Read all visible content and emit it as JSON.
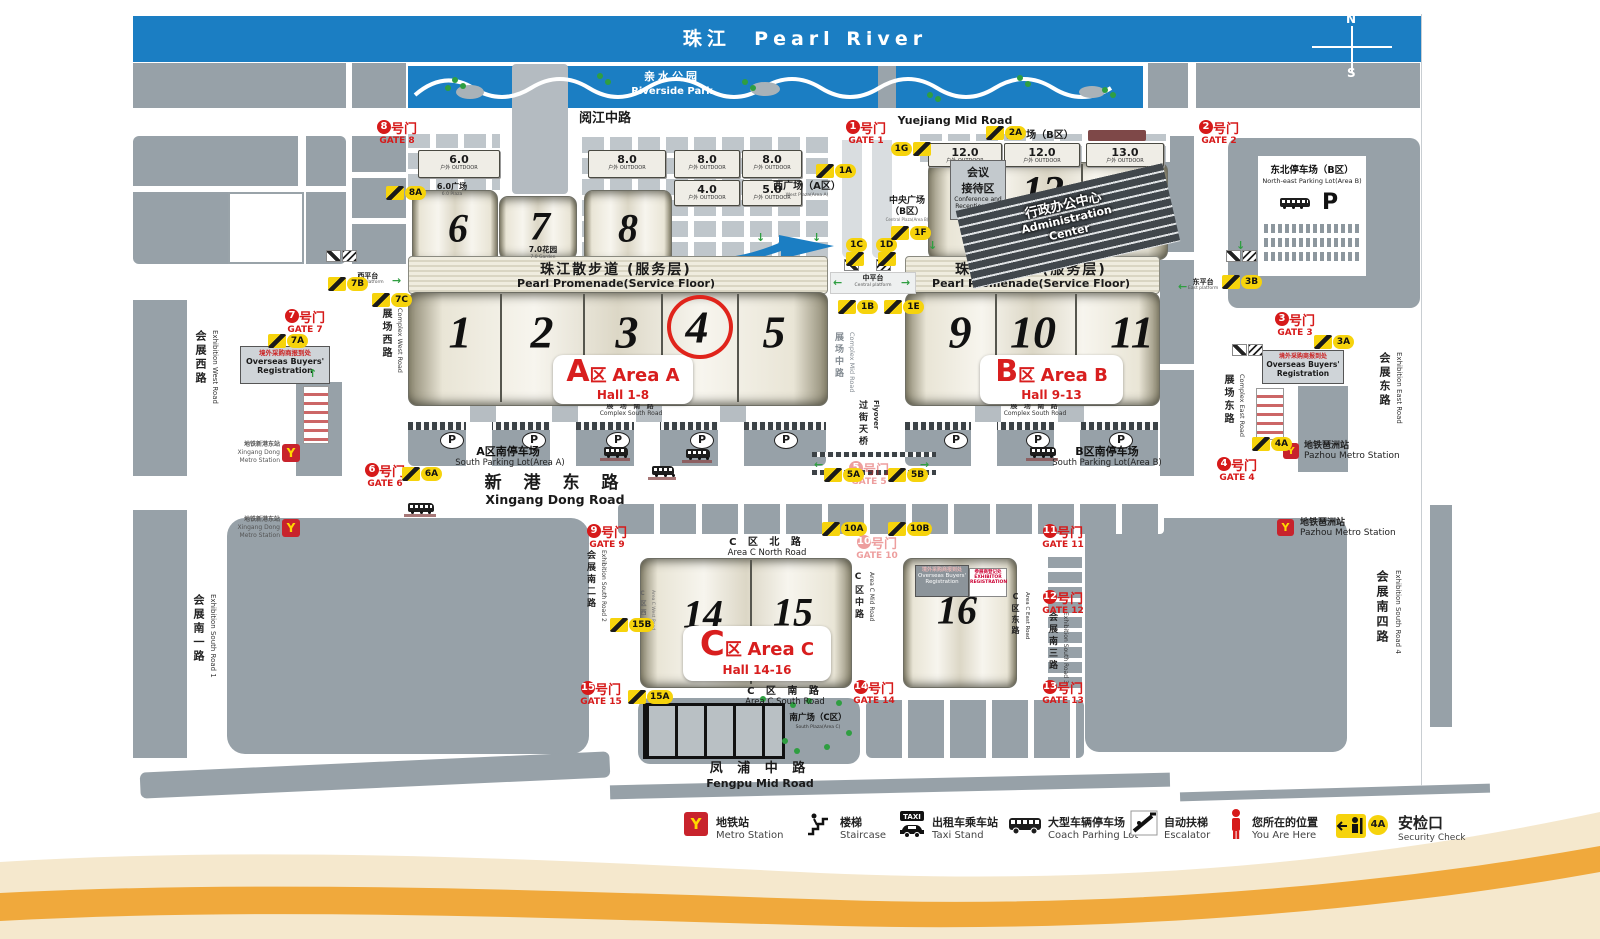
{
  "river": {
    "cn": "珠江",
    "en": "Pearl River"
  },
  "compass": {
    "n": "N",
    "s": "S"
  },
  "park": {
    "cn": "亲水公园",
    "en": "Riverside Park"
  },
  "promenade": {
    "cn": "珠江散步道 (服务层)",
    "en": "Pearl Promenade(Service Floor)"
  },
  "roads": {
    "yuejiang": {
      "cn": "阅江中路",
      "en": "Yuejiang  Mid Road"
    },
    "xingang": {
      "cn": "新 港 东 路",
      "en": "Xingang Dong Road"
    },
    "fengpu": {
      "cn": "凤 浦 中 路",
      "en": "Fengpu Mid Road"
    },
    "area_c_north": {
      "cn": "C 区 北 路",
      "en": "Area C  North  Road"
    },
    "area_c_south": {
      "cn": "C 区 南 路",
      "en": "Area C South  Road"
    },
    "area_c_mid": {
      "cn": "C区中路",
      "en": "Area C Mid Road"
    },
    "area_c_east": {
      "cn": "C区东路",
      "en": "Area C East Road"
    },
    "area_c_west": {
      "cn": "C区西路",
      "en": "Area C West Road"
    },
    "complex_west": {
      "cn": "展场西路",
      "en": "Complex West Road"
    },
    "complex_mid": {
      "cn": "展场中路",
      "en": "Complex Mid Road"
    },
    "complex_east": {
      "cn": "展场东路",
      "en": "Complex East Road"
    },
    "complex_south": {
      "cn": "展 场 南 路",
      "en": "Complex South Road"
    },
    "exhibition_west": {
      "cn": "会展西路",
      "en": "Exhibition West Road"
    },
    "exhibition_east": {
      "cn": "会展东路",
      "en": "Exhibition East Road"
    },
    "exh_south_1": {
      "cn": "会展南一路",
      "en": "Exhibition South Road 1"
    },
    "exh_south_2": {
      "cn": "会展南二路",
      "en": "Exhibition South Road 2"
    },
    "exh_south_3": {
      "cn": "会展南三路",
      "en": "Exhibition South Road 3"
    },
    "exh_south_4": {
      "cn": "会展南四路",
      "en": "Exhibition South Road 4"
    },
    "flyover": {
      "cn": "过街天桥",
      "en": "Flyover"
    }
  },
  "platforms": {
    "west": {
      "cn": "西平台",
      "en": "West platform"
    },
    "central": {
      "cn": "中平台",
      "en": "Central platform"
    },
    "east": {
      "cn": "东平台",
      "en": "East platform"
    }
  },
  "areas": {
    "a": {
      "letter": "A",
      "qu": "区",
      "en": "Area A",
      "halls": "Hall 1-8"
    },
    "b": {
      "letter": "B",
      "qu": "区",
      "en": "Area B",
      "halls": "Hall 9-13"
    },
    "c": {
      "letter": "C",
      "qu": "区",
      "en": "Area C",
      "halls": "Hall 14-16"
    }
  },
  "halls": [
    "1",
    "2",
    "3",
    "4",
    "5",
    "6",
    "7",
    "8",
    "9",
    "10",
    "11",
    "12",
    "13",
    "14",
    "15",
    "16"
  ],
  "outdoor": [
    {
      "num": "6.0",
      "sub": "户外 OUTDOOR"
    },
    {
      "num": "8.0",
      "sub": "户外 OUTDOOR"
    },
    {
      "num": "8.0",
      "sub": "户外 OUTDOOR"
    },
    {
      "num": "8.0",
      "sub": "户外 OUTDOOR"
    },
    {
      "num": "4.0",
      "sub": "户外 OUTDOOR"
    },
    {
      "num": "5.0",
      "sub": "户外 OUTDOOR"
    },
    {
      "num": "12.0",
      "sub": "户外 OUTDOOR"
    },
    {
      "num": "12.0",
      "sub": "户外 OUTDOOR"
    },
    {
      "num": "13.0",
      "sub": "户外 OUTDOOR"
    }
  ],
  "plazas": {
    "p60": {
      "cn": "6.0广场",
      "en": "6.0 Plaza"
    },
    "p70": {
      "cn": "7.0花园",
      "en": "7.0 Garden"
    },
    "west_a": {
      "cn": "西广场（A区）",
      "en": "West Plaza(Area A)"
    },
    "east_b": {
      "cn": "东广场（B区）"
    },
    "central_b": {
      "cn1": "中央广场",
      "cn2": "（B区）",
      "en": "Central Plaza(Area B)"
    },
    "south_c": {
      "cn": "南广场（C区）",
      "en": "South Plaza(Area C)"
    }
  },
  "admin": {
    "cn": "行政办公中心",
    "en1": "Administration",
    "en2": "Center"
  },
  "conference": {
    "cn1": "会议",
    "cn2": "接待区",
    "en1": "Conference and",
    "en2": "Reception Area"
  },
  "registration": {
    "cn": "境外采购商报到处",
    "en1": "Overseas Buyers'",
    "en2": "Registration"
  },
  "exhibitor": {
    "cn": "参展商登记处",
    "en1": "EXHIBITOR",
    "en2": "REGISTRATION"
  },
  "parking": {
    "p": "P",
    "south_a": {
      "cn": "A区南停车场",
      "en": "South Parking Lot(Area A)"
    },
    "south_b": {
      "cn": "B区南停车场",
      "en": "South Parking Lot(Area B)"
    },
    "ne": {
      "cn": "东北停车场（B区）",
      "en": "North-east Parking Lot(Area B)"
    }
  },
  "metro": {
    "xingang": {
      "cn": "地铁新港东站",
      "en1": "Xingang Dong",
      "en2": "Metro Station"
    },
    "pazhou": {
      "cn": "地铁琶洲站",
      "en": "Pazhou Metro Station"
    }
  },
  "gates": [
    {
      "n": "1",
      "cn": "号门",
      "en": "GATE 1"
    },
    {
      "n": "2",
      "cn": "号门",
      "en": "GATE 2"
    },
    {
      "n": "3",
      "cn": "号门",
      "en": "GATE 3"
    },
    {
      "n": "4",
      "cn": "号门",
      "en": "GATE 4"
    },
    {
      "n": "5",
      "cn": "号门",
      "en": "GATE 5"
    },
    {
      "n": "6",
      "cn": "号门",
      "en": "GATE 6"
    },
    {
      "n": "7",
      "cn": "号门",
      "en": "GATE 7"
    },
    {
      "n": "8",
      "cn": "号门",
      "en": "GATE 8"
    },
    {
      "n": "9",
      "cn": "号门",
      "en": "GATE 9"
    },
    {
      "n": "10",
      "cn": "号门",
      "en": "GATE 10"
    },
    {
      "n": "11",
      "cn": "号门",
      "en": "GATE 11"
    },
    {
      "n": "12",
      "cn": "号门",
      "en": "GATE 12"
    },
    {
      "n": "13",
      "cn": "号门",
      "en": "GATE 13"
    },
    {
      "n": "14",
      "cn": "号门",
      "en": "GATE 14"
    },
    {
      "n": "15",
      "cn": "号门",
      "en": "GATE 15"
    }
  ],
  "badges": [
    "8A",
    "7B",
    "7C",
    "7A",
    "1A",
    "1G",
    "2A",
    "1C",
    "1D",
    "1F",
    "1B",
    "1E",
    "3B",
    "3A",
    "6A",
    "5A",
    "5B",
    "10A",
    "10B",
    "4A",
    "15B",
    "15A"
  ],
  "legend": [
    {
      "cn": "地铁站",
      "en": "Metro Station"
    },
    {
      "cn": "楼梯",
      "en": "Staircase"
    },
    {
      "cn": "出租车乘车站",
      "en": "Taxi Stand",
      "icon_text": "TAXI"
    },
    {
      "cn": "大型车辆停车场",
      "en": "Coach Parhing Lot"
    },
    {
      "cn": "自动扶梯",
      "en": "Escalator"
    },
    {
      "cn": "您所在的位置",
      "en": "You Are Here"
    },
    {
      "cn": "安检口",
      "en": "Security Check",
      "badge": "4A"
    }
  ],
  "colors": {
    "river": "#1b7ec3",
    "block": "#97a1a8",
    "accent_red": "#d61c1c",
    "badge_yellow": "#f6d30c",
    "wave_cream": "#f5e8cd",
    "wave_orange": "#f0a93c"
  }
}
